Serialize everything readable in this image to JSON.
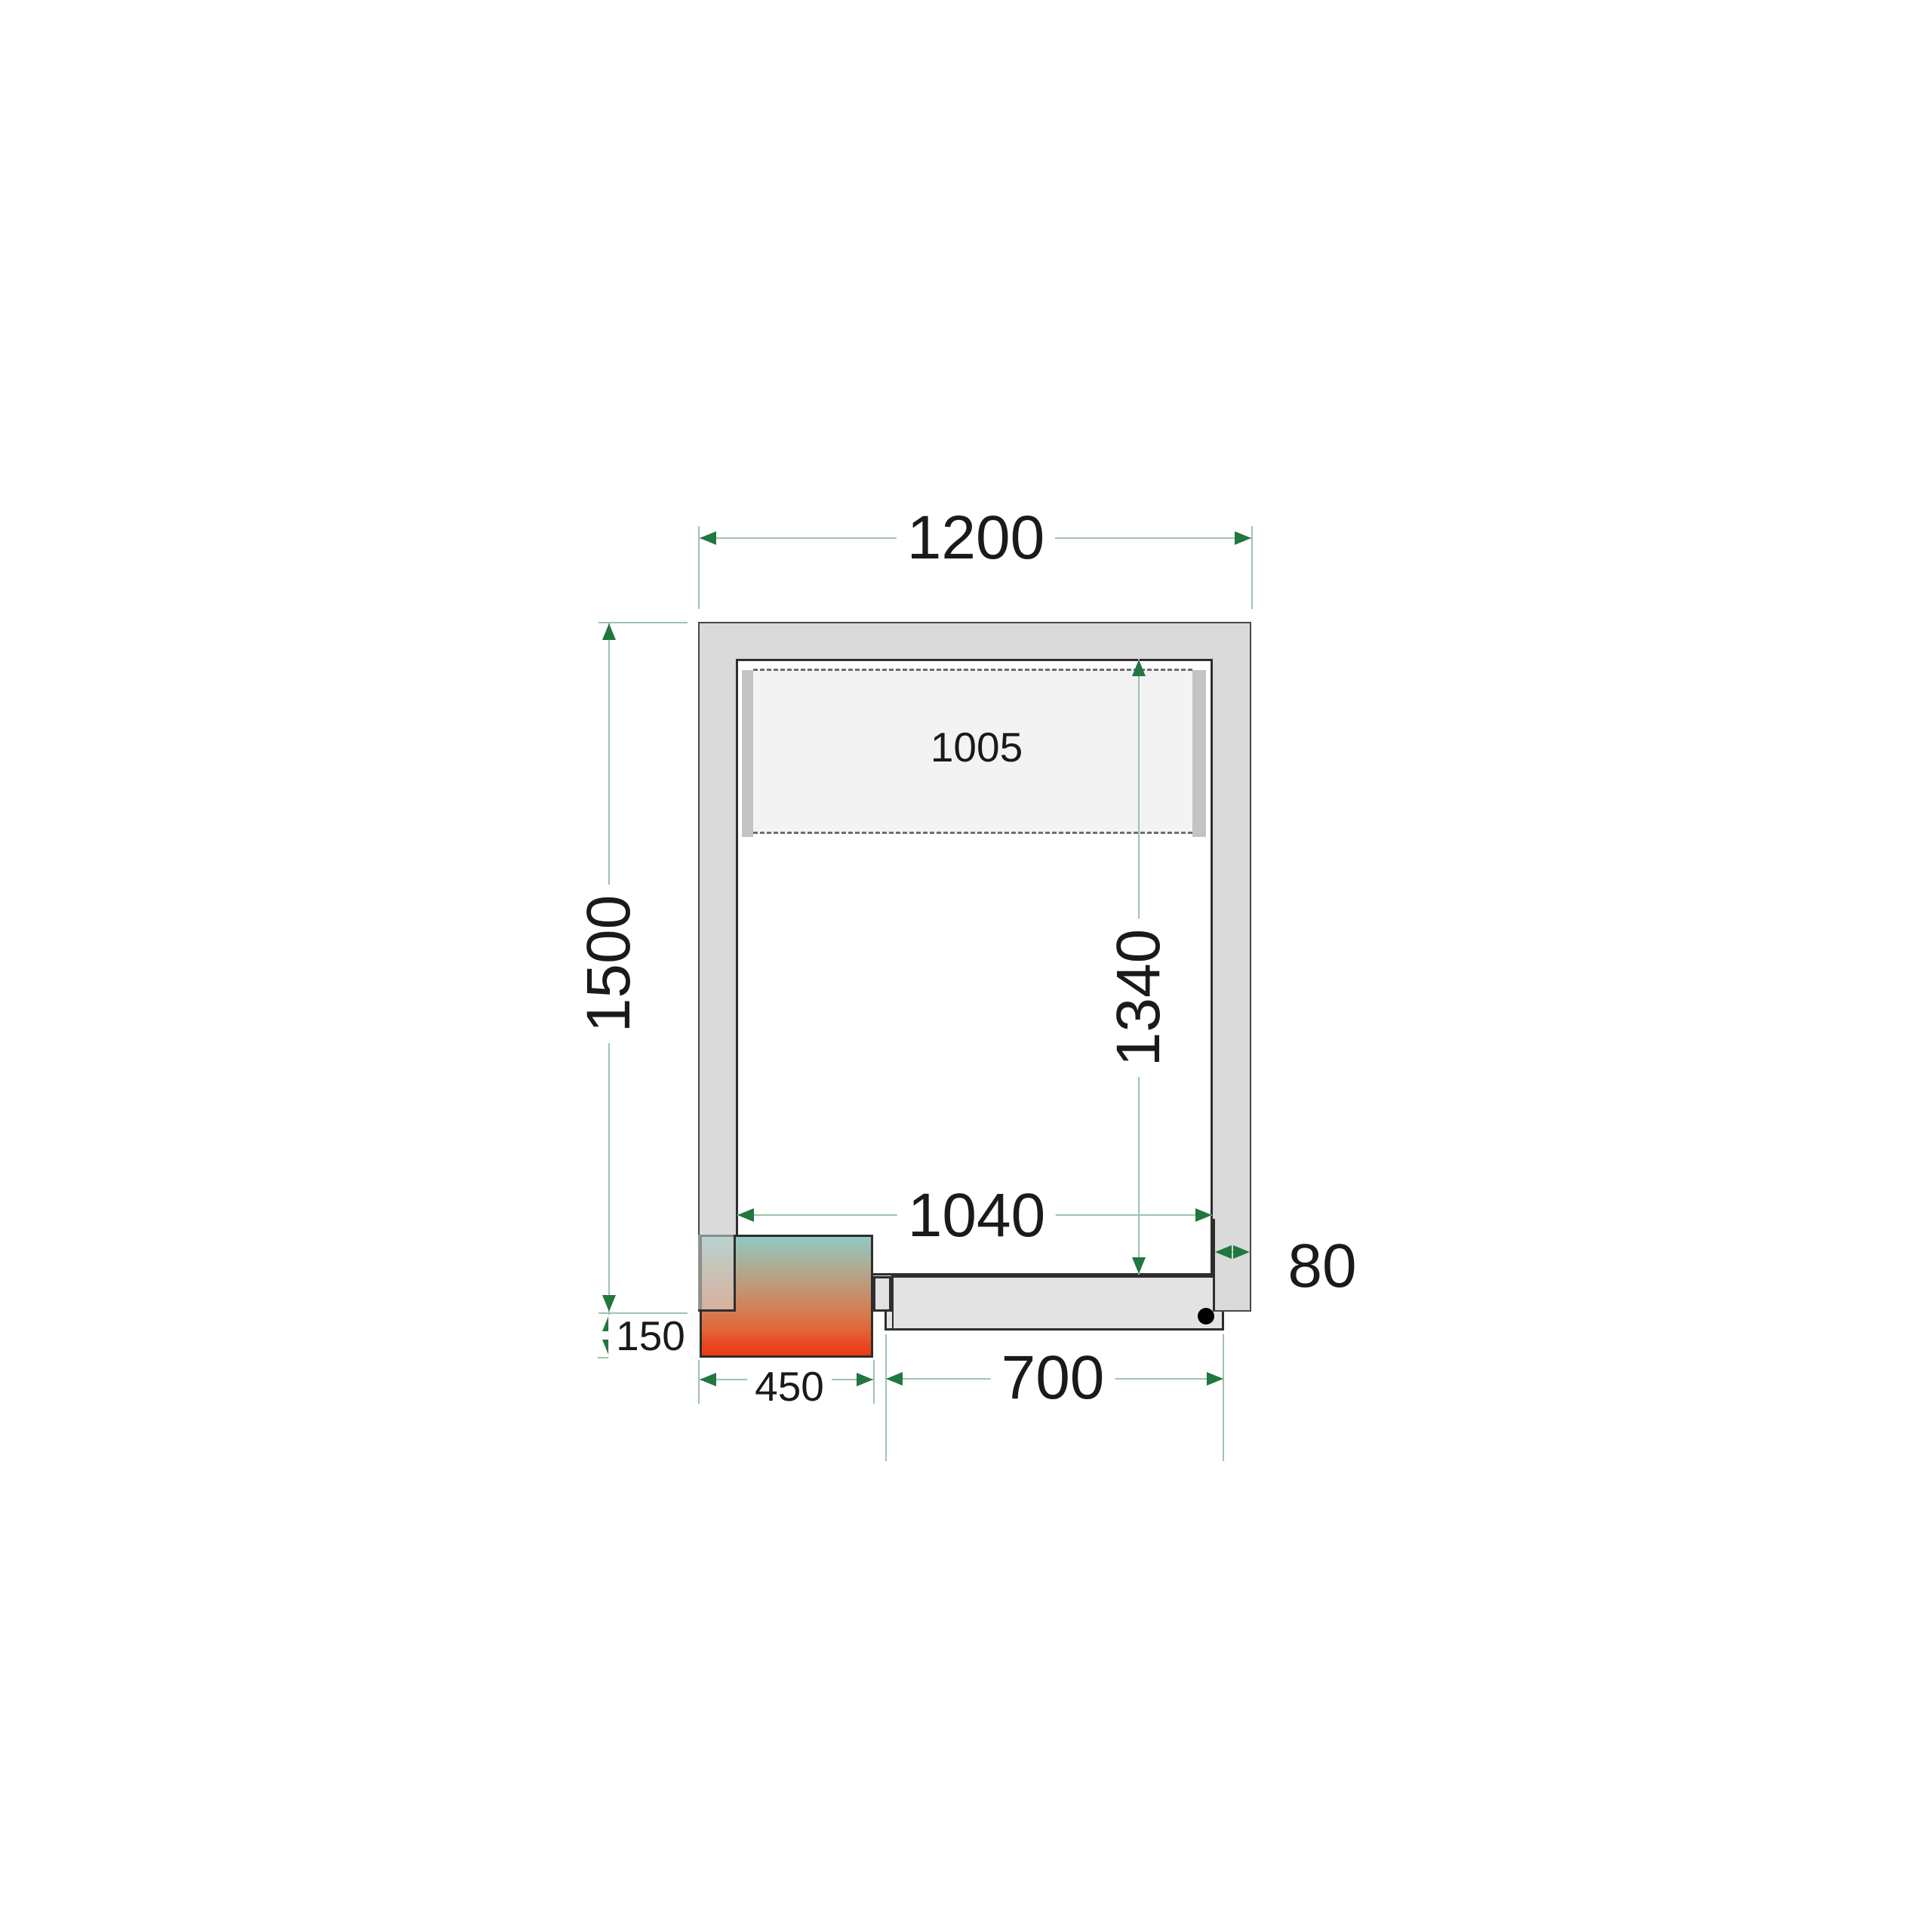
{
  "drawing": {
    "type": "cold-room-floor-plan-top-view",
    "labels": {
      "outer_width": "1200",
      "outer_depth": "1500",
      "inner_depth": "1340",
      "inner_width": "1040",
      "wall_thickness": "80",
      "unit_protrusion": "150",
      "unit_width": "450",
      "door_width": "700",
      "shelf_width": "1005"
    }
  },
  "colors": {
    "dim_line": "#9fc3ae",
    "dim_arrow": "#22763f",
    "wall_fill": "#dadada",
    "outline_dark": "#2e2e2e",
    "shelf_fill": "#f3f3f3",
    "rail_fill": "#c3c3c3",
    "door_fill": "#e3e3e3",
    "text": "#1a1a1a",
    "unit_gradient": [
      "#8ecac5 0%",
      "#a9b29b 20%",
      "#c09778 42%",
      "#d18257 60%",
      "#e2663a 78%",
      "#ea4520 92%",
      "#ea3b18 100%"
    ]
  }
}
